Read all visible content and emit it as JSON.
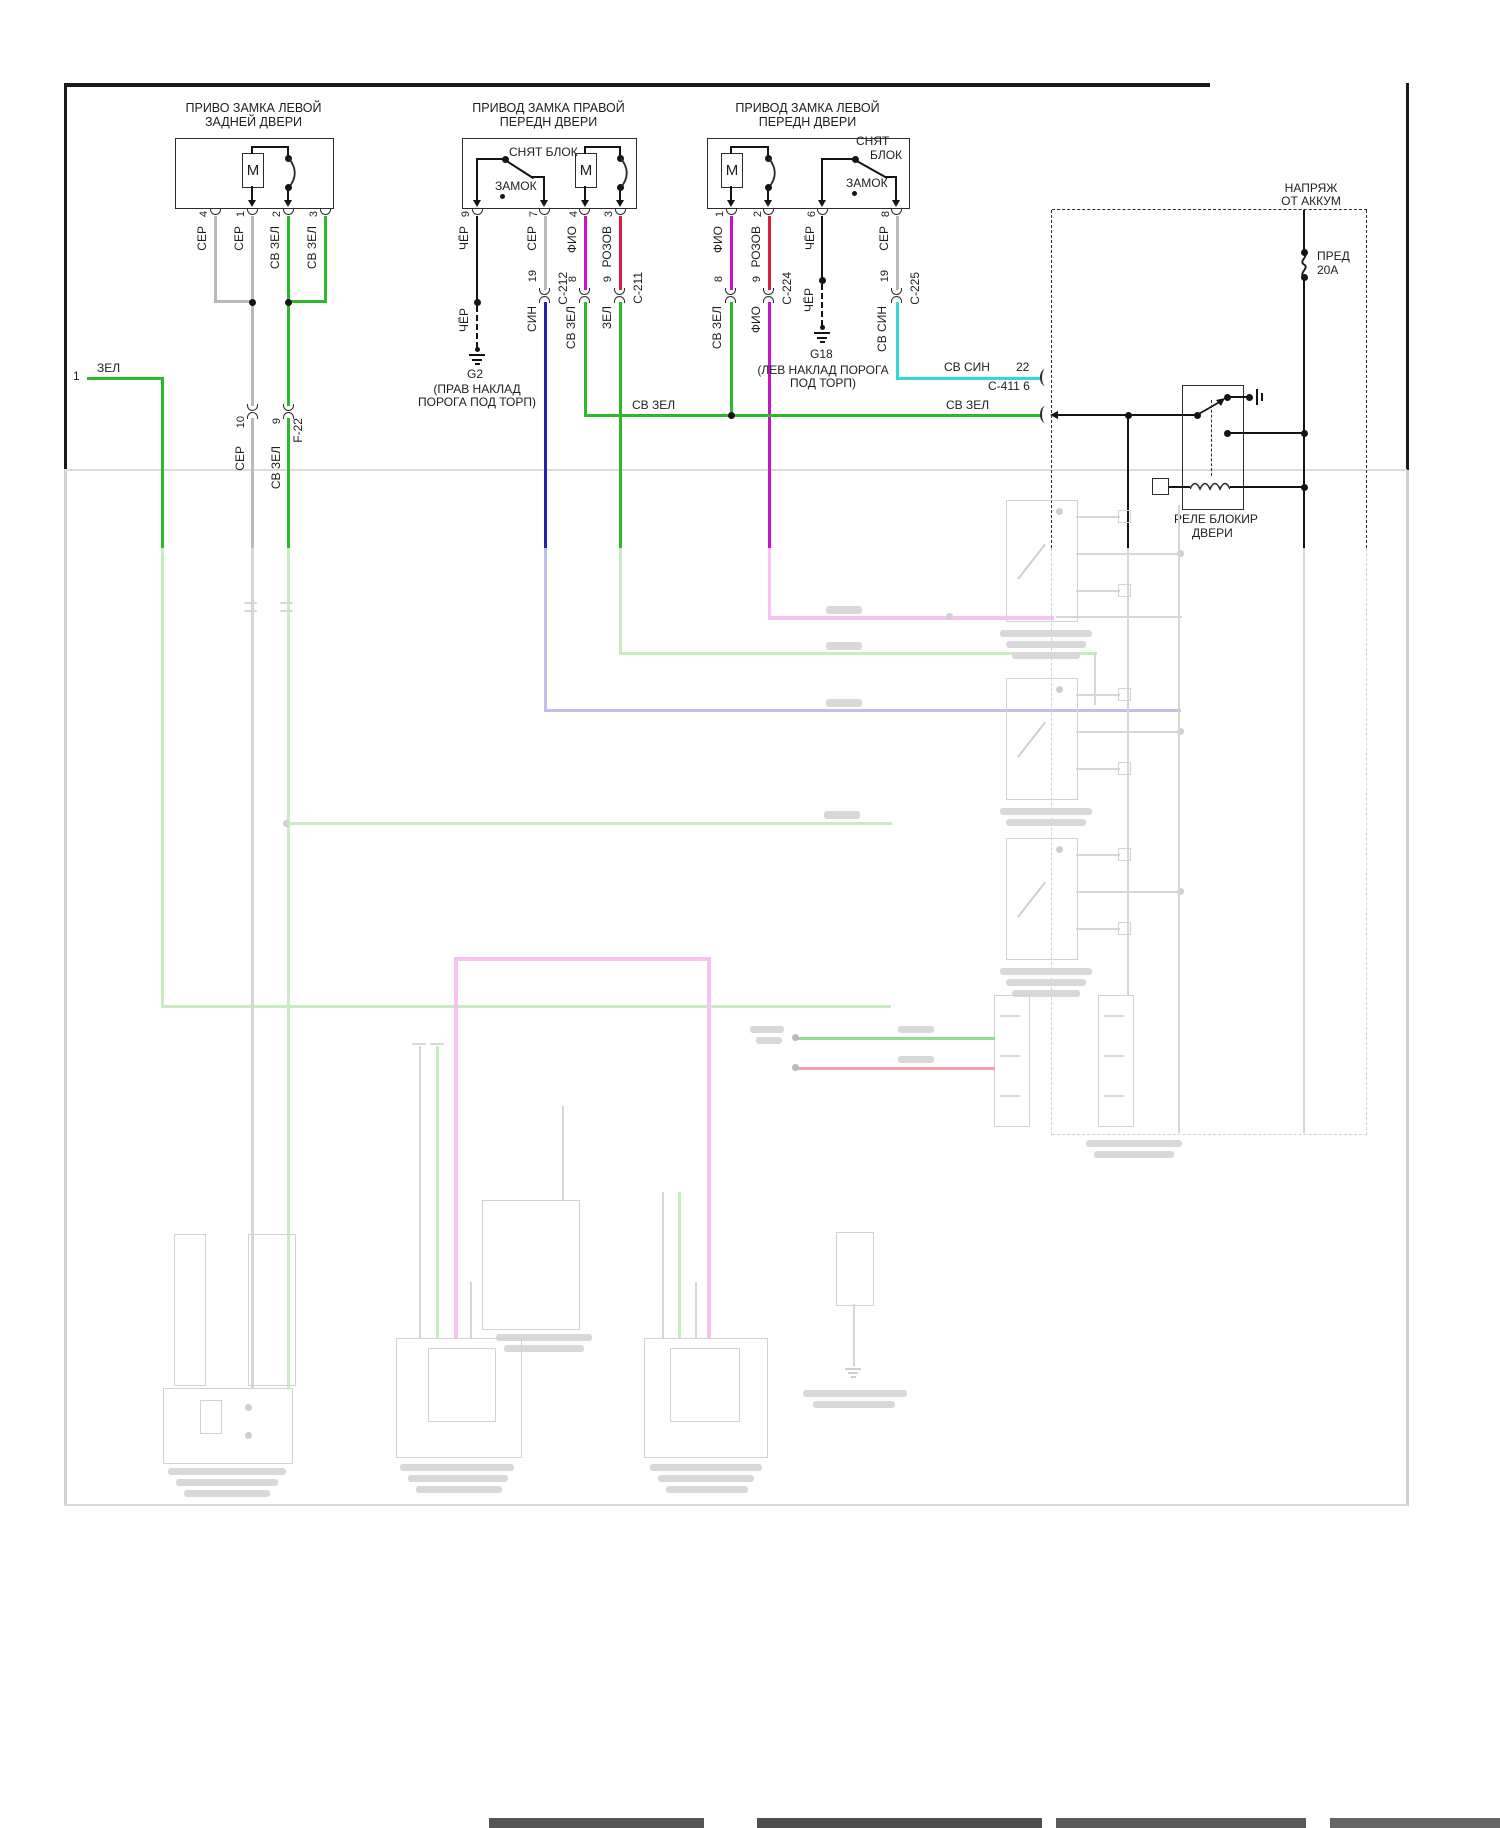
{
  "left_entry": {
    "num": "1",
    "wire": "ЗЕЛ"
  },
  "rear_left_lock": {
    "title1": "ПРИВО ЗАМКА ЛЕВОЙ",
    "title2": "ЗАДНЕЙ ДВЕРИ",
    "motor": "M",
    "pin4": "4",
    "pin1": "1",
    "pin2": "2",
    "pin3": "3",
    "wire4": "СЕР",
    "wire1": "СЕР",
    "wire2": "СВ ЗЕЛ",
    "wire3": "СВ ЗЕЛ",
    "conn_pin_a": "10",
    "conn_pin_b": "9",
    "conn_name": "F-22",
    "below_a": "СЕР",
    "below_b": "СВ ЗЕЛ"
  },
  "front_right_lock": {
    "title1": "ПРИВОД ЗАМКА ПРАВОЙ",
    "title2": "ПЕРЕДН ДВЕРИ",
    "motor": "M",
    "sw_released": "СНЯТ БЛОК",
    "sw_locked": "ЗАМОК",
    "pin9": "9",
    "pin7": "7",
    "pin4": "4",
    "pin3": "3",
    "wire9": "ЧЁР",
    "wire7": "СЕР",
    "wire4": "ФИО",
    "wire3": "РОЗОВ",
    "wire9b": "ЧЁР",
    "c212_pin": "19",
    "c212": "C-212",
    "c212_below": "СИН",
    "p8": "8",
    "p8_below": "СВ ЗЕЛ",
    "c211_pin": "9",
    "c211": "C-211",
    "c211_below": "ЗЕЛ",
    "ground": "G2",
    "ground_cap1": "(ПРАВ НАКЛАД",
    "ground_cap2": "ПОРОГА ПОД ТОРП)"
  },
  "front_left_lock": {
    "title1": "ПРИВОД ЗАМКА ЛЕВОЙ",
    "title2": "ПЕРЕДН ДВЕРИ",
    "motor": "M",
    "sw_released1": "СНЯТ",
    "sw_released2": "БЛОК",
    "sw_locked": "ЗАМОК",
    "pin1": "1",
    "pin2": "2",
    "pin6": "6",
    "pin8": "8",
    "wire1": "ФИО",
    "wire2": "РОЗОВ",
    "wire6": "ЧЁР",
    "wire8": "СЕР",
    "wire6b": "ЧЁР",
    "p8": "8",
    "p8_below": "СВ ЗЕЛ",
    "c224_pin": "9",
    "c224": "C-224",
    "c224_below": "ФИО",
    "c225_pin": "19",
    "c225": "C-225",
    "c225_below": "СВ СИН",
    "ground": "G18",
    "ground_cap1": "(ЛЕВ НАКЛАД ПОРОГА",
    "ground_cap2": "ПОД ТОРП)"
  },
  "bus": {
    "sv_sin_label": "СВ СИН",
    "sv_sin_pin": "22",
    "sv_sin_conn": "C-411 6",
    "sv_zel_label_mid": "СВ ЗЕЛ",
    "sv_zel_label_right": "СВ ЗЕЛ"
  },
  "power": {
    "src1": "НАПРЯЖ",
    "src2": "ОТ АККУМ",
    "fuse1": "ПРЕД",
    "fuse2": "20А"
  },
  "relay": {
    "name1": "РЕЛЕ БЛОКИР",
    "name2": "ДВЕРИ"
  },
  "colors": {
    "green": "#2eb82e",
    "gray": "#b9b9b9",
    "black": "#141414",
    "blue": "#2222b2",
    "magenta": "#c813c8",
    "red": "#d81f3f",
    "cyan": "#35d6d6",
    "ghost_pink": "#f4c3ef",
    "ghost_green": "#c9ecc2",
    "ghost_periwinkle": "#c0c0e8",
    "ghost_red": "#f0a3a3",
    "ghost_gray": "#d6d6d6"
  }
}
